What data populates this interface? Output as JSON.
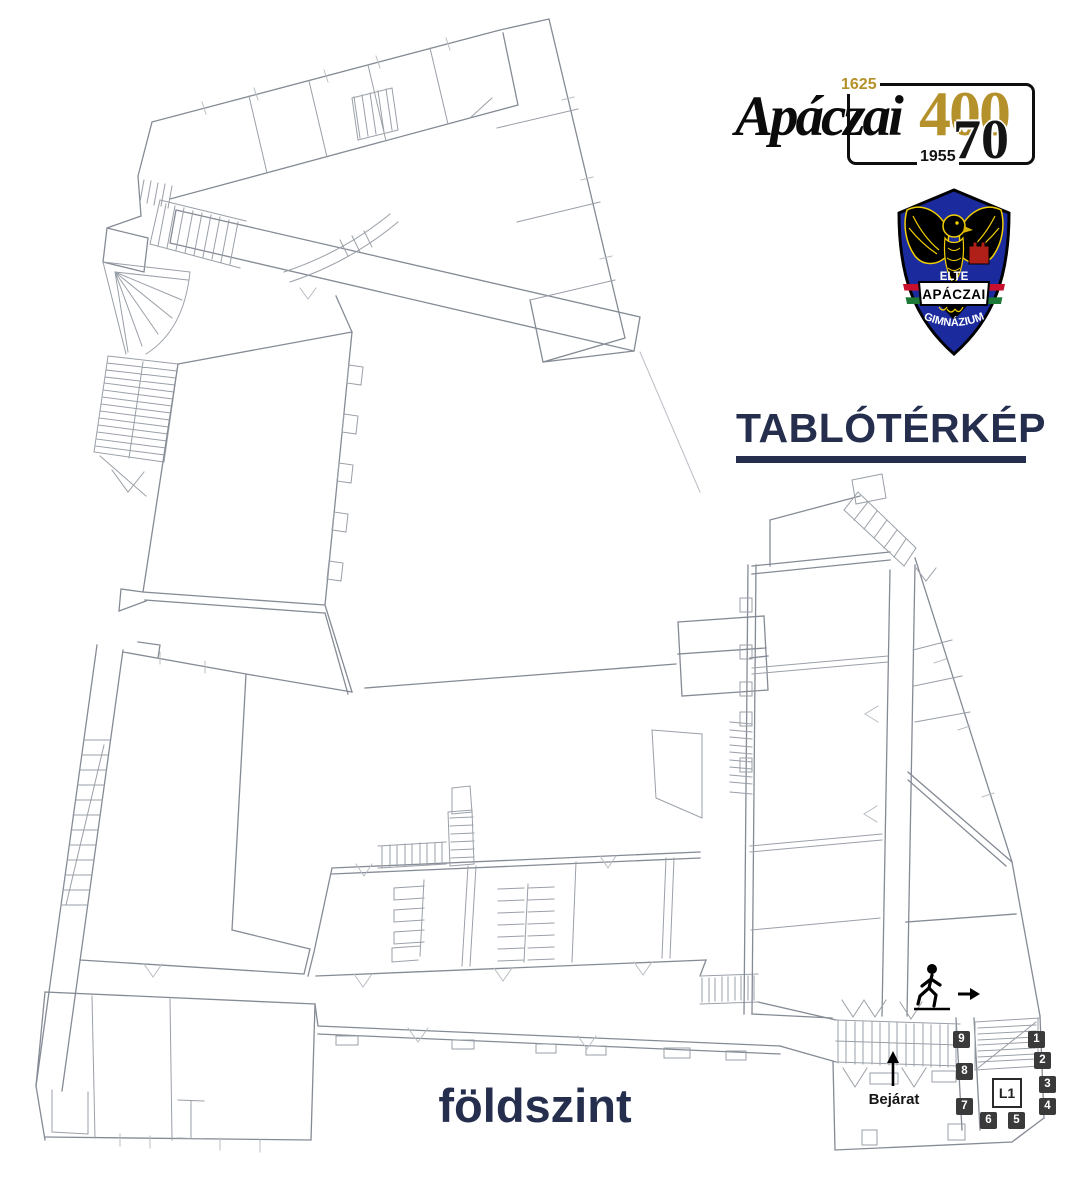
{
  "branding": {
    "logo": {
      "wordmark": "Apáczai",
      "year_top": "1625",
      "year_bottom": "1955",
      "anniversary_primary": "400",
      "anniversary_secondary": "70"
    },
    "crest": {
      "institution": "ELTE",
      "school": "APÁCZAI",
      "school_type": "GIMNÁZIUM"
    }
  },
  "page": {
    "title": "TABLÓTÉRKÉP",
    "floor_label": "földszint"
  },
  "map": {
    "entrance_label": "Bejárat",
    "lift_label": "L1",
    "markers": [
      "1",
      "2",
      "3",
      "4",
      "5",
      "6",
      "7",
      "8",
      "9"
    ]
  },
  "colors": {
    "title_navy": "#262e4e",
    "logo_gold": "#b5912c",
    "crest_blue": "#1b2b9e",
    "crest_yellow": "#f2d000",
    "crest_red": "#b02018",
    "badge_dark": "#3a3a3a",
    "plan_line_gray": "#8e949d"
  }
}
